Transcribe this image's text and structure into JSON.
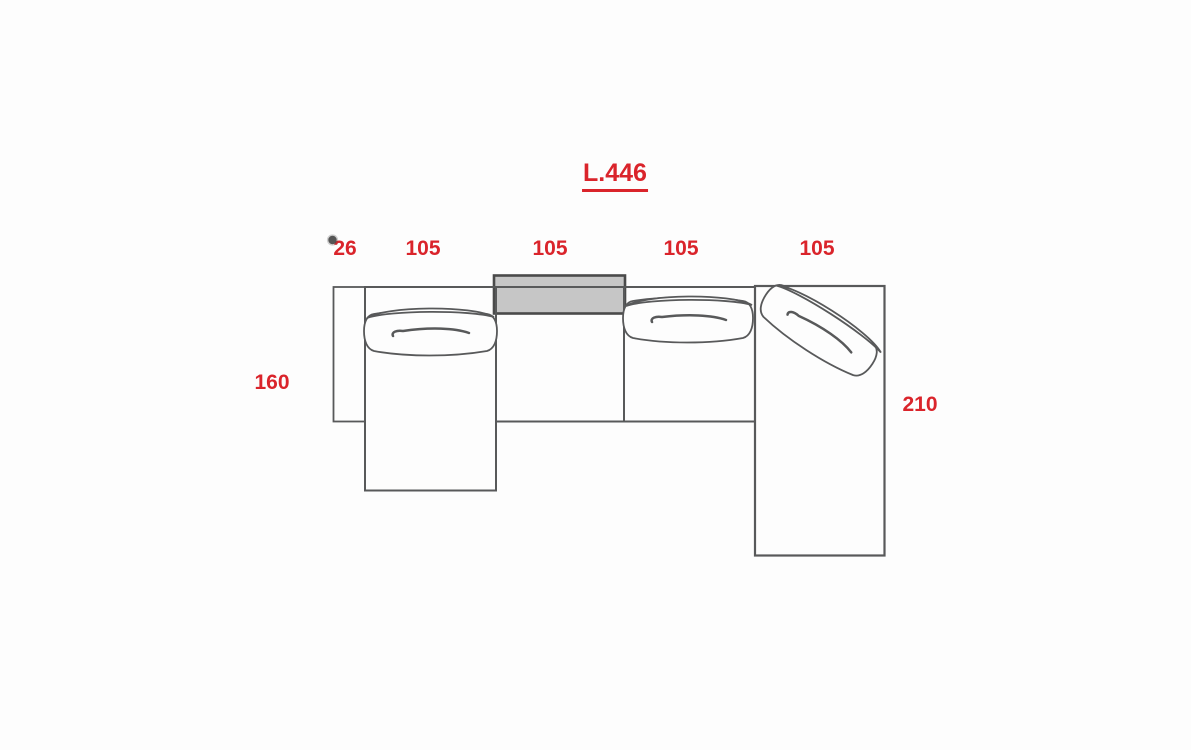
{
  "title": {
    "text": "L.446"
  },
  "dimensions": {
    "top": [
      {
        "label": "26"
      },
      {
        "label": "105"
      },
      {
        "label": "105"
      },
      {
        "label": "105"
      },
      {
        "label": "105"
      }
    ],
    "left": {
      "label": "160"
    },
    "right": {
      "label": "210"
    }
  },
  "colors": {
    "dimension_red": "#da242b",
    "outline_gray": "#58595a",
    "headrest_fill": "#c6c6c6"
  },
  "diagram": {
    "type": "sofa-top-view",
    "parts": [
      "left-armrest",
      "left-chaise-seat",
      "middle-seat-with-gray-headrest",
      "right-seat",
      "right-chaise-with-angled-cushion"
    ]
  }
}
